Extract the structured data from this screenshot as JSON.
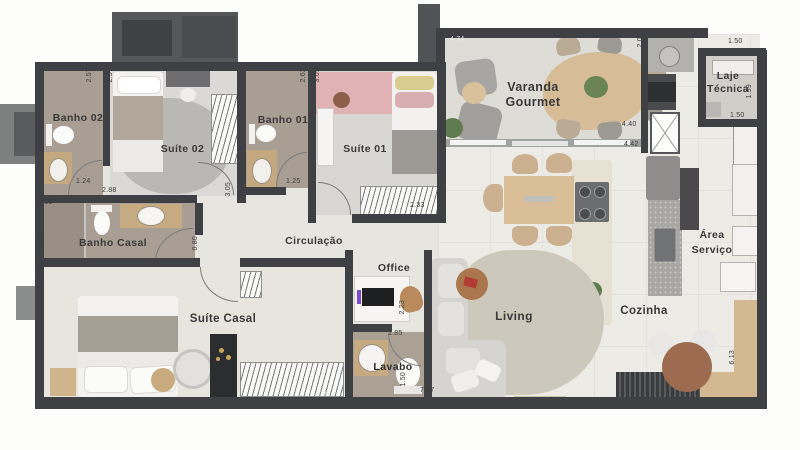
{
  "rooms": {
    "banho02": "Banho 02",
    "suite02": "Suíte 02",
    "banho01": "Banho 01",
    "suite01": "Suíte 01",
    "varanda_1": "Varanda",
    "varanda_2": "Gourmet",
    "laje_1": "Laje",
    "laje_2": "Técnica",
    "banho_casal": "Banho Casal",
    "circulacao": "Circulação",
    "office": "Office",
    "suite_casal": "Suíte Casal",
    "living": "Living",
    "cozinha": "Cozinha",
    "area_1": "Área",
    "area_2": "Serviço",
    "lavabo": "Lavabo"
  },
  "dims": {
    "v257a": "2.57",
    "v257b": "2.57",
    "h124": "1.24",
    "h288": "2.88",
    "h315": "3.15",
    "v305a": "3.05",
    "v262": "2.62",
    "v305b": "3.05",
    "h125": "1.25",
    "h233": "2.33",
    "h545": "5.45",
    "h474": "4.74",
    "v202": "2.02",
    "h150a": "1.50",
    "v139": "1.39",
    "h150b": "1.50",
    "h440": "4.40",
    "h442": "4.42",
    "v130": "1.30",
    "v080": "0.80",
    "v260": "2.60",
    "v223": "2.23",
    "h185": "1.85",
    "v150c": "1.50",
    "h638": "6.38",
    "h747": "7.47",
    "v613": "6.13"
  },
  "colors": {
    "wall": "#3e4043",
    "floor_light": "#eae8e3",
    "floor_bath": "#a89e94",
    "wood": "#d6ba94",
    "rug_gray": "#bab8b4",
    "rug_pink": "#e0b2b3",
    "rug_living": "#ccc8bc",
    "dark_cabinet": "#2c2d2f",
    "accent_red": "#b23c34",
    "plant_green": "#5e7c50"
  }
}
